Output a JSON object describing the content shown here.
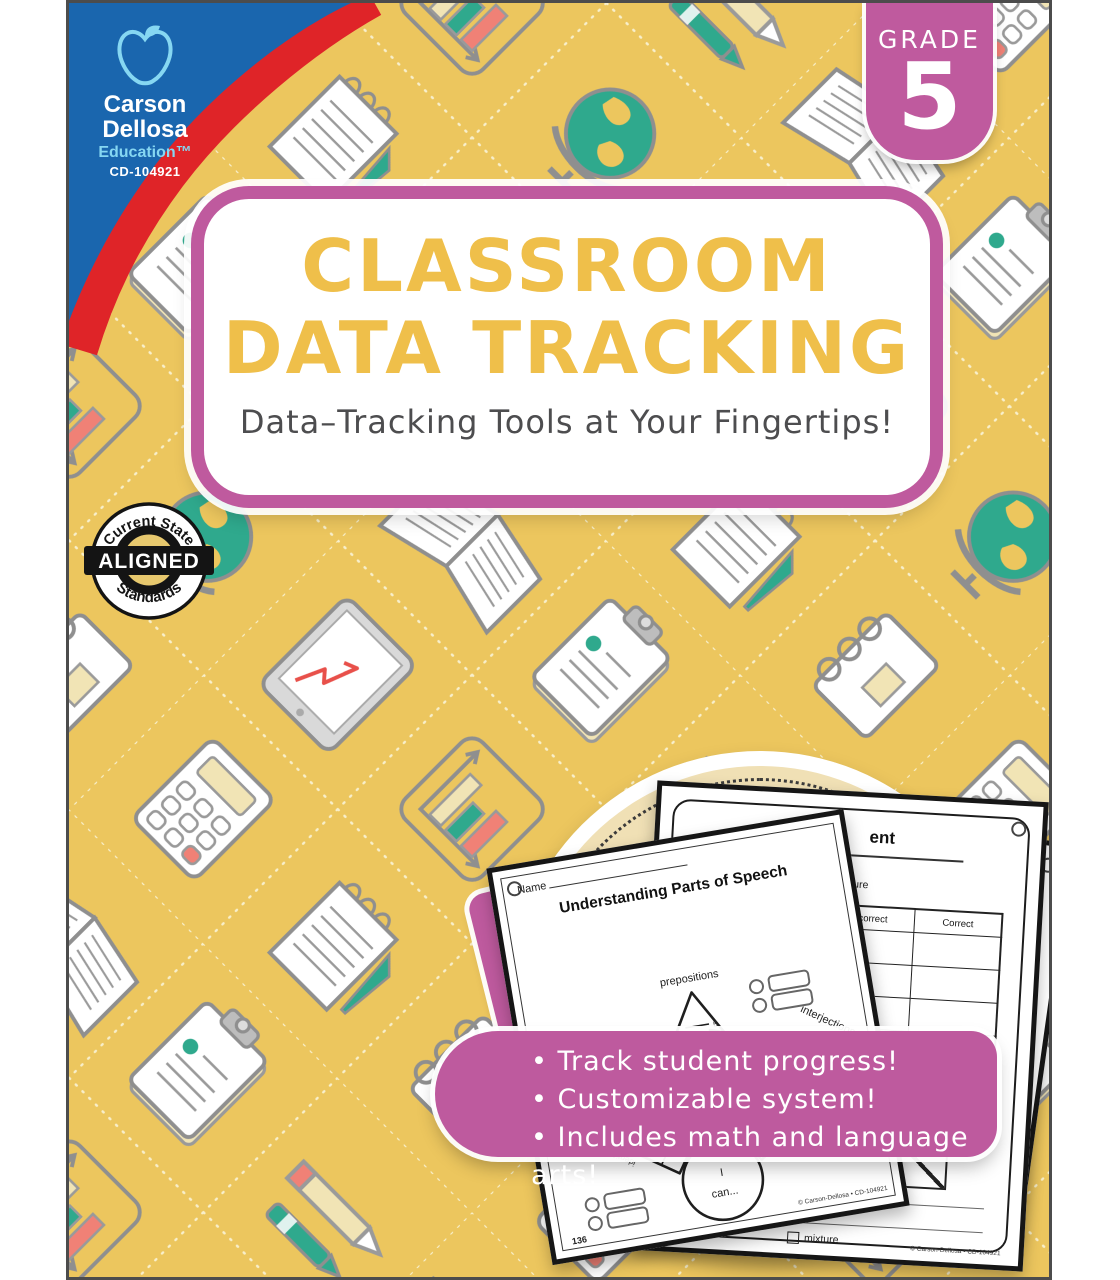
{
  "cover": {
    "publisher": {
      "brand_line1": "Carson",
      "brand_line2": "Dellosa",
      "brand_line3": "Education™",
      "product_code": "CD-104921"
    },
    "grade_tab": {
      "label": "GRADE",
      "value": "5"
    },
    "title_card": {
      "title_line1": "CLASSROOM",
      "title_line2": "DATA TRACKING",
      "subtitle": "Data–Tracking Tools at Your Fingertips!"
    },
    "standards_badge": {
      "arc_top": "Current State",
      "band": "ALIGNED",
      "arc_bottom": "Standards"
    },
    "bullets": [
      "Track student progress!",
      "Customizable system!",
      "Includes math and language arts!"
    ],
    "worksheets": {
      "front": {
        "name_label": "Name",
        "title": "Understanding Parts of Speech",
        "label_top": "prepositions",
        "label_left_line1": "perfect tense",
        "label_left_line2": "verbs",
        "label_right": "interjections",
        "center_line1": "I",
        "center_line2": "can...",
        "word_identify": "identify",
        "word_use": "use",
        "tick_numbers": [
          "1",
          "2",
          "3",
          "4",
          "5"
        ],
        "page_number": "136",
        "copyright": "© Carson-Dellosa • CD-104921"
      },
      "middle": {
        "title_fragment": "ent",
        "checkbox_label": "mixture",
        "col_incorrect": "Incorrect",
        "col_correct": "Correct",
        "total_label": "Total",
        "copyright": "© Carson-Dellosa • CD-104921"
      },
      "right": {
        "line1": "an identify",
        "line2": "nd interpret",
        "line3": "nification."
      }
    },
    "colors": {
      "cover_yellow": "#ECC65E",
      "brand_blue": "#1A66AE",
      "brand_red": "#DF2428",
      "magenta": "#BE5A9E",
      "title_gold": "#EFBF4A",
      "teal": "#2FA98D",
      "salmon": "#F08176",
      "text_dark": "#4D4D4F"
    }
  }
}
